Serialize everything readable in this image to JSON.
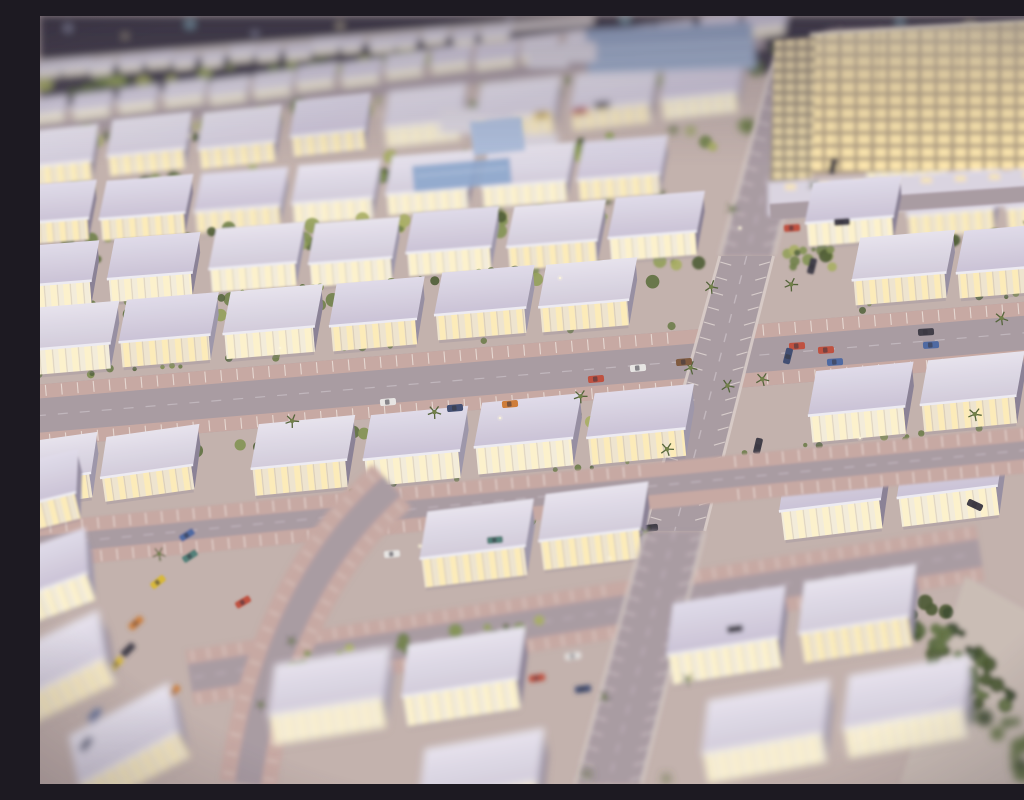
{
  "meta": {
    "title": "Night-lit architectural scale model of a residential masterplan with rows of illuminated villas, palm-lined streets, parked model cars and a glowing hotel block",
    "type": "photograph",
    "style": "tilt-shift depth of field, sharp center band, blurred top and bottom"
  },
  "palette": {
    "ground": "#c3b1ab",
    "asphalt": "#a89aa0",
    "paleWalk": "#cfc6c3",
    "bay": "#c8a8a1",
    "tick": "#efe5de",
    "roofTop": "#e9e5ee",
    "roofBottom": "#d3ccdb",
    "fascia": "#f0eef4",
    "sideWalls": [
      "#958da0",
      "#887f93",
      "#9c95a8"
    ],
    "facadeBase": "#f1e6cf",
    "windowBright": "#ffeeb8",
    "windowHot": "#fff4cc",
    "tableDark1": "#35303c",
    "tableDark2": "#4a4350",
    "edgeWall": "#d8d2da",
    "glass": "#96a8c6",
    "glassStripe": "#cfdaea",
    "pool": "#8ca6cc",
    "canopyTop": "#aebfdc",
    "canopyBottom": "#8da3c8",
    "hotelFrame": "#8f8270",
    "hotelParapet": "#ece6d6",
    "podium": "#dcd5e1",
    "carColors": {
      "Y": "#d9b832",
      "O": "#cf7a33",
      "R": "#bf4b38",
      "B": "#4a66a0",
      "N": "#3c4a6e",
      "D": "#3a3742",
      "W": "#e9e7e4",
      "Br": "#7d5638",
      "T": "#4e7d74"
    },
    "carGlass": "#2f2d36",
    "treePalettes": {
      "g": [
        "#5d6c3a",
        "#6f7f45",
        "#81914e",
        "#4c5a31",
        "#93a057",
        "#a8ae5e"
      ],
      "d": [
        "#46552e",
        "#55663a",
        "#39482a",
        "#5f7040"
      ],
      "s": [
        "#55643a",
        "#6b7b44",
        "#7d8c4c"
      ]
    },
    "palmFrond": "#4f5f33",
    "palmCrown": "#6d7d42",
    "bokeh": [
      "#cdd6f4",
      "#f4e6b8",
      "#a8e4f0",
      "#e8d0f0"
    ],
    "glint": "#fff8dc"
  },
  "scene": {
    "seed": 7,
    "table": [
      [
        0,
        0
      ],
      [
        1024,
        0
      ],
      [
        1024,
        8
      ],
      [
        790,
        14
      ],
      [
        726,
        58
      ],
      [
        545,
        14
      ],
      [
        395,
        34
      ],
      [
        0,
        96
      ]
    ],
    "edgeWall": [
      [
        0,
        96
      ],
      [
        395,
        34
      ],
      [
        545,
        14
      ]
    ],
    "bokeh": [
      [
        28,
        12,
        4,
        0
      ],
      [
        85,
        20,
        3,
        1
      ],
      [
        150,
        8,
        5,
        2
      ],
      [
        215,
        18,
        3,
        0
      ],
      [
        300,
        10,
        4,
        1
      ],
      [
        395,
        22,
        3,
        3
      ],
      [
        470,
        6,
        4,
        0
      ],
      [
        585,
        4,
        5,
        2
      ],
      [
        640,
        16,
        4,
        1
      ],
      [
        700,
        4,
        3,
        0
      ],
      [
        860,
        6,
        4,
        2
      ],
      [
        930,
        10,
        5,
        1
      ],
      [
        985,
        18,
        4,
        0
      ],
      [
        1010,
        6,
        3,
        2
      ]
    ],
    "rows": [
      [
        -5,
        58,
        -4.7,
        26,
        22,
        9,
        6,
        6,
        460
      ],
      [
        -10,
        100,
        -7,
        18,
        36,
        15,
        10,
        9,
        715
      ],
      [
        -25,
        152,
        -6,
        8,
        76,
        36,
        20,
        17,
        715
      ],
      [
        -35,
        210,
        -4.5,
        11,
        80,
        38,
        21,
        16,
        1040
      ],
      [
        -30,
        270,
        -4.5,
        11,
        84,
        40,
        23,
        16,
        1040
      ],
      [
        -24,
        335,
        -4.8,
        10,
        88,
        42,
        25,
        17,
        1040
      ],
      [
        -10,
        475,
        -5.5,
        9,
        94,
        44,
        27,
        18,
        1040
      ],
      [
        25,
        585,
        -7,
        8,
        100,
        46,
        29,
        20,
        900
      ],
      [
        230,
        700,
        -9,
        5,
        112,
        50,
        30,
        22,
        820
      ],
      [
        380,
        788,
        -10,
        4,
        120,
        52,
        30,
        24,
        1040
      ]
    ],
    "extraHouses": [
      [
        -58,
        500,
        -14,
        95,
        42,
        26,
        "f1b"
      ],
      [
        -48,
        592,
        -20,
        100,
        44,
        28,
        "f2b"
      ],
      [
        -30,
        688,
        -26,
        105,
        46,
        28,
        "f3b"
      ],
      [
        40,
        768,
        -28,
        110,
        48,
        28,
        "f3b"
      ],
      [
        -40,
        470,
        -8,
        90,
        40,
        24,
        "f0"
      ],
      [
        62,
        462,
        -8,
        90,
        40,
        24,
        "f0"
      ]
    ],
    "streetsH": [
      [
        -10,
        116,
        740,
        13,
        -7,
        0,
        0,
        "f3a"
      ],
      [
        -5,
        50,
        560,
        10,
        -4.7,
        0,
        1,
        "f3a"
      ],
      [
        730,
        196,
        320,
        16,
        -4,
        0,
        0,
        "f1a"
      ],
      [
        -30,
        402,
        1090,
        62,
        -4.8,
        1,
        0,
        "f0"
      ],
      [
        -10,
        530,
        1050,
        46,
        -5.5,
        1,
        0,
        "f1b"
      ],
      [
        150,
        662,
        800,
        56,
        -9,
        1,
        0,
        "f2b"
      ]
    ],
    "vstreet": {
      "topX": 763,
      "topY": 25,
      "slope": -0.262,
      "hwTop": 23,
      "hwBot": 32,
      "segs": [
        [
          25,
          240,
          "f2a"
        ],
        [
          240,
          515,
          "f0"
        ],
        [
          515,
          768,
          "f2b"
        ]
      ]
    },
    "curve": {
      "p0": [
        352,
        470
      ],
      "p1": [
        235,
        575
      ],
      "p2": [
        208,
        768
      ],
      "baseW": 26,
      "bayW": 58,
      "band": "f2b"
    },
    "gardens": [
      [
        0,
        74,
        -5,
        450,
        14,
        40,
        "g",
        0
      ],
      [
        -10,
        128,
        -6,
        730,
        22,
        55,
        "g",
        0
      ],
      [
        -30,
        182,
        -5,
        745,
        24,
        60,
        "g",
        0
      ],
      [
        -35,
        242,
        -4.5,
        1070,
        26,
        85,
        "g",
        1
      ],
      [
        -30,
        306,
        -4.5,
        1065,
        26,
        85,
        "g",
        1
      ],
      [
        40,
        448,
        -5,
        560,
        18,
        30,
        "g",
        1
      ],
      [
        30,
        545,
        -6.5,
        640,
        22,
        45,
        "g",
        1
      ],
      [
        240,
        652,
        -9,
        330,
        20,
        22,
        "g",
        0
      ],
      [
        -10,
        555,
        -30,
        180,
        26,
        25,
        "g",
        0
      ],
      [
        862,
        560,
        56,
        265,
        48,
        75,
        "d",
        0
      ],
      [
        995,
        320,
        80,
        240,
        18,
        20,
        "g",
        0
      ],
      [
        -20,
        295,
        -4.5,
        1050,
        6,
        26,
        "s",
        1
      ],
      [
        -14,
        362,
        -4.8,
        1040,
        6,
        26,
        "s",
        1
      ],
      [
        0,
        504,
        -5.5,
        1020,
        6,
        22,
        "s",
        1
      ]
    ],
    "palmLines": [
      {
        "from": [
          734,
          30
        ],
        "to": [
          545,
          760
        ],
        "n": 10
      },
      {
        "from": [
          800,
          70
        ],
        "to": [
          625,
          760
        ],
        "n": 8
      },
      {
        "from": [
          250,
          404
        ],
        "to": [
          690,
          372
        ],
        "n": 4
      },
      {
        "from": [
          120,
          536
        ],
        "to": [
          600,
          500
        ],
        "n": 4
      },
      {
        "from": [
          318,
          492
        ],
        "to": [
          222,
          690
        ],
        "n": 4
      },
      {
        "from": [
          990,
          210
        ],
        "to": [
          935,
          400
        ],
        "n": 3
      }
    ],
    "cars": [
      [
        348,
        386,
        -5,
        "W"
      ],
      [
        415,
        392,
        -5,
        "N"
      ],
      [
        470,
        388,
        -5,
        "O"
      ],
      [
        556,
        363,
        -5,
        "R"
      ],
      [
        598,
        352,
        -5,
        "W"
      ],
      [
        644,
        346,
        -5,
        "Br"
      ],
      [
        757,
        330,
        -4,
        "R"
      ],
      [
        786,
        334,
        -4,
        "R"
      ],
      [
        795,
        346,
        -4,
        "B"
      ],
      [
        886,
        316,
        -4,
        "D"
      ],
      [
        891,
        329,
        -4,
        "B"
      ],
      [
        287,
        546,
        -5,
        "Br"
      ],
      [
        352,
        538,
        -5,
        "W"
      ],
      [
        455,
        524,
        -5,
        "T"
      ],
      [
        610,
        512,
        -6,
        "D"
      ],
      [
        497,
        662,
        -8,
        "R"
      ],
      [
        533,
        640,
        -8,
        "W"
      ],
      [
        543,
        673,
        -8,
        "N"
      ],
      [
        682,
        569,
        -7,
        "Y"
      ],
      [
        647,
        588,
        -7,
        "O"
      ],
      [
        695,
        613,
        -7,
        "D"
      ],
      [
        793,
        150,
        -76,
        "D"
      ],
      [
        772,
        250,
        -76,
        "D"
      ],
      [
        748,
        340,
        -76,
        "N"
      ],
      [
        718,
        430,
        -77,
        "D"
      ],
      [
        935,
        489,
        25,
        "D"
      ],
      [
        118,
        566,
        -38,
        "Y"
      ],
      [
        96,
        607,
        -42,
        "O"
      ],
      [
        88,
        634,
        -45,
        "D"
      ],
      [
        76,
        648,
        -46,
        "Y"
      ],
      [
        55,
        700,
        -50,
        "B"
      ],
      [
        46,
        728,
        -52,
        "N"
      ],
      [
        203,
        586,
        -30,
        "R"
      ],
      [
        133,
        676,
        -45,
        "O"
      ],
      [
        150,
        540,
        -33,
        "T"
      ],
      [
        147,
        519,
        -32,
        "B"
      ],
      [
        540,
        95,
        -7,
        "R"
      ],
      [
        562,
        89,
        -7,
        "D"
      ],
      [
        502,
        99,
        -7,
        "Y"
      ],
      [
        752,
        212,
        -4,
        "R"
      ],
      [
        802,
        206,
        -4,
        "D"
      ]
    ],
    "hotel": {
      "main": [
        [
          770,
          18
        ],
        [
          1024,
          2
        ],
        [
          1024,
          152
        ],
        [
          762,
          158
        ]
      ],
      "tower": [
        [
          734,
          24
        ],
        [
          776,
          20
        ],
        [
          772,
          162
        ],
        [
          730,
          168
        ]
      ],
      "podium": [
        [
          728,
          166
        ],
        [
          1024,
          152
        ],
        [
          1024,
          188
        ],
        [
          728,
          200
        ]
      ],
      "band": "f2a"
    },
    "glassBuilding": [
      [
        545,
        14
      ],
      [
        712,
        6
      ],
      [
        716,
        52
      ],
      [
        548,
        58
      ]
    ],
    "whiteBlocks": [
      [
        400,
        92,
        38,
        26
      ],
      [
        444,
        100,
        30,
        22
      ],
      [
        478,
        118,
        40,
        24
      ],
      [
        488,
        30,
        40,
        22
      ],
      [
        520,
        26,
        36,
        20
      ]
    ],
    "canopy": [
      430,
      106,
      52,
      34,
      -6
    ],
    "pool": [
      372,
      150,
      98,
      26,
      -5
    ],
    "paleCorner": [
      [
        925,
        560
      ],
      [
        1024,
        615
      ],
      [
        1024,
        768
      ],
      [
        860,
        768
      ]
    ],
    "glints": [
      [
        150,
        120
      ],
      [
        340,
        98
      ],
      [
        520,
        262
      ],
      [
        700,
        212
      ],
      [
        240,
        332
      ],
      [
        460,
        402
      ],
      [
        660,
        472
      ],
      [
        820,
        422
      ],
      [
        90,
        232
      ],
      [
        570,
        542
      ],
      [
        380,
        530
      ],
      [
        250,
        655
      ]
    ]
  }
}
